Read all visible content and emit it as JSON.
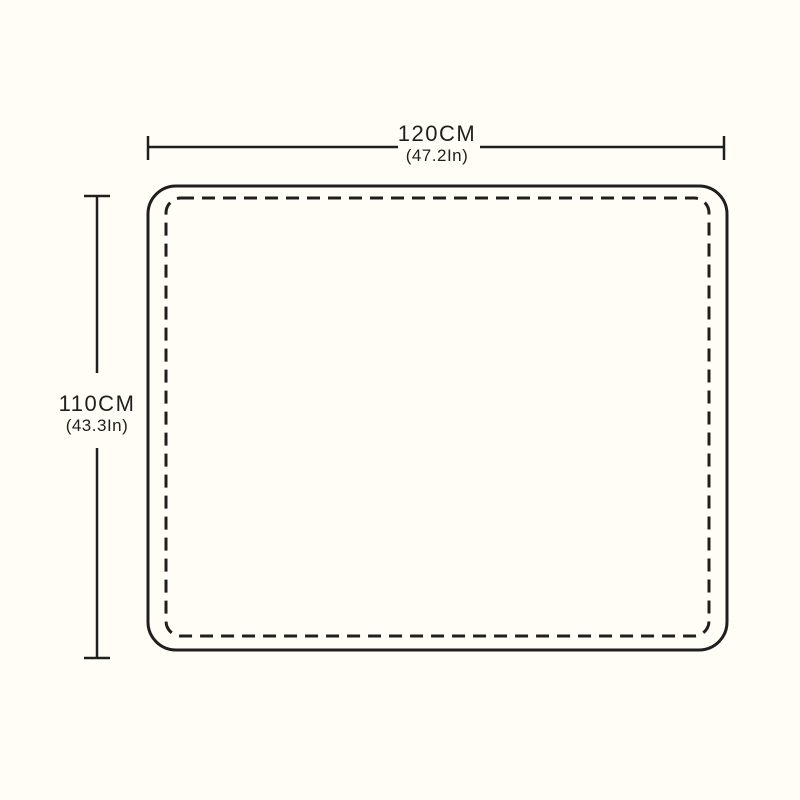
{
  "diagram": {
    "type": "product-size-diagram",
    "shape": "rounded-rectangle-with-stitched-border",
    "width": {
      "metric": "120CM",
      "imperial": "(47.2In)"
    },
    "height": {
      "metric": "110CM",
      "imperial": "(43.3In)"
    }
  },
  "colors": {
    "ink": "#1f1f1f",
    "background": "#fffdf5"
  }
}
